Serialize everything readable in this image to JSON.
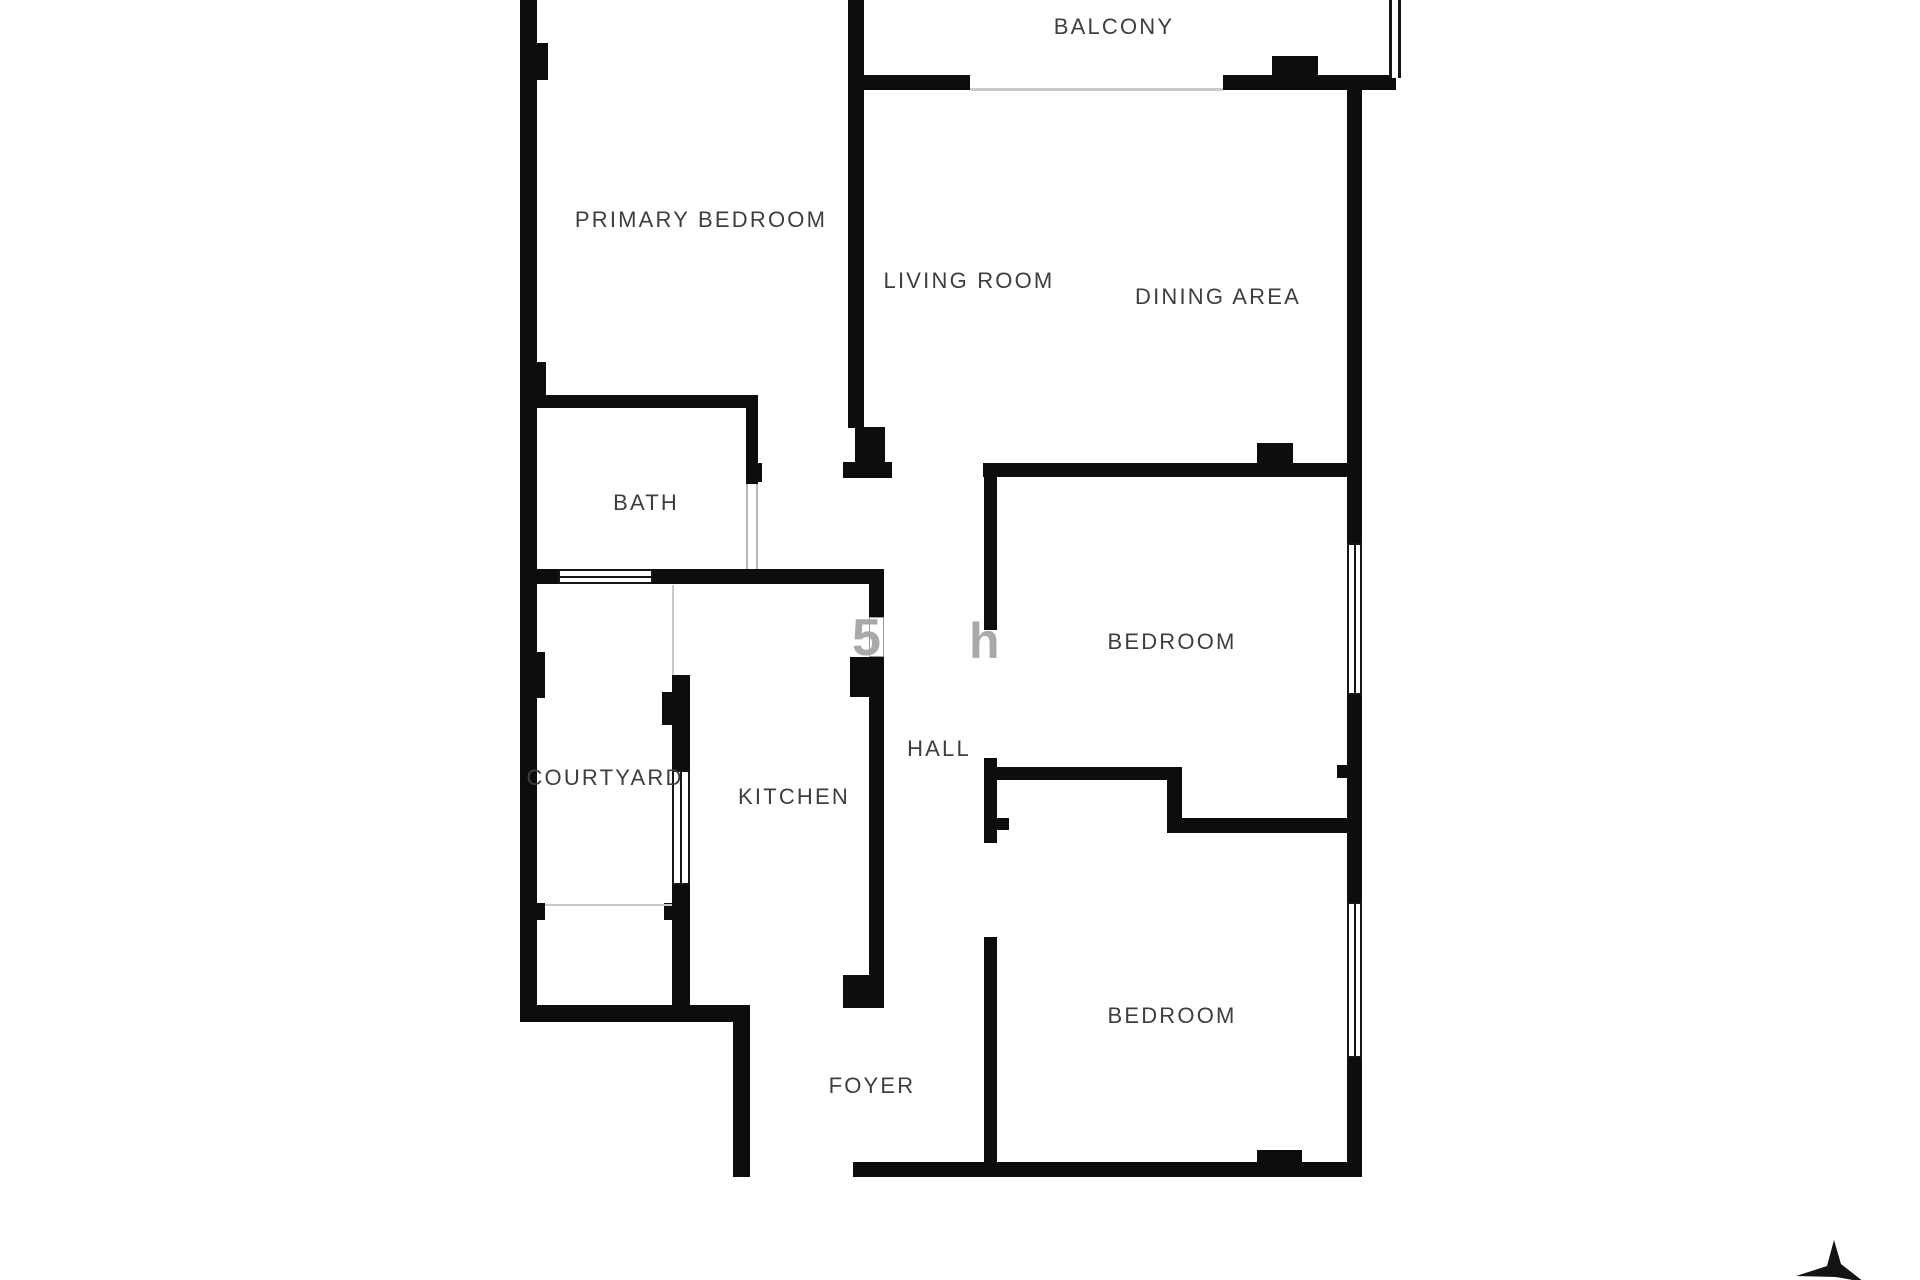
{
  "page": {
    "background": "#ffffff",
    "wall_color": "#0d0d0d",
    "label_color": "#3e3e3e",
    "watermark_color": "#a5a5a5",
    "title": "Apartment floor plan"
  },
  "rooms": [
    {
      "id": "balcony",
      "name": "BALCONY",
      "cx": 1114,
      "cy": 27
    },
    {
      "id": "primary-bedroom",
      "name": "PRIMARY BEDROOM",
      "cx": 701,
      "cy": 220
    },
    {
      "id": "living-room",
      "name": "LIVING ROOM",
      "cx": 969,
      "cy": 281
    },
    {
      "id": "dining-area",
      "name": "DINING AREA",
      "cx": 1218,
      "cy": 297
    },
    {
      "id": "bath",
      "name": "BATH",
      "cx": 646,
      "cy": 503
    },
    {
      "id": "bedroom-1",
      "name": "BEDROOM",
      "cx": 1172,
      "cy": 642
    },
    {
      "id": "courtyard",
      "name": "COURTYARD",
      "cx": 605,
      "cy": 778
    },
    {
      "id": "kitchen",
      "name": "KITCHEN",
      "cx": 794,
      "cy": 797
    },
    {
      "id": "hall",
      "name": "HALL",
      "cx": 939,
      "cy": 749
    },
    {
      "id": "bedroom-2",
      "name": "BEDROOM",
      "cx": 1172,
      "cy": 1016
    },
    {
      "id": "foyer",
      "name": "FOYER",
      "cx": 872,
      "cy": 1086
    }
  ],
  "watermark": {
    "fragments": [
      {
        "char": "5",
        "x": 852,
        "y": 612,
        "size": 52
      },
      {
        "char": "h",
        "x": 969,
        "y": 616,
        "size": 50
      }
    ]
  },
  "floorplan": {
    "walls": [
      [
        520,
        0,
        17,
        1022
      ],
      [
        537,
        43,
        11,
        37
      ],
      [
        537,
        362,
        9,
        38
      ],
      [
        520,
        395,
        238,
        13
      ],
      [
        746,
        408,
        12,
        76
      ],
      [
        754,
        463,
        8,
        19
      ],
      [
        848,
        0,
        16,
        428
      ],
      [
        855,
        427,
        30,
        36
      ],
      [
        843,
        462,
        49,
        16
      ],
      [
        848,
        75,
        122,
        15
      ],
      [
        1223,
        75,
        173,
        15
      ],
      [
        1272,
        56,
        46,
        19
      ],
      [
        1347,
        88,
        15,
        455
      ],
      [
        1347,
        695,
        15,
        207
      ],
      [
        1347,
        1058,
        15,
        119
      ],
      [
        983,
        463,
        379,
        14
      ],
      [
        1257,
        443,
        36,
        20
      ],
      [
        984,
        477,
        13,
        153
      ],
      [
        984,
        758,
        13,
        85
      ],
      [
        997,
        818,
        12,
        12
      ],
      [
        984,
        937,
        13,
        225
      ],
      [
        984,
        767,
        198,
        13
      ],
      [
        1167,
        780,
        15,
        53
      ],
      [
        1167,
        818,
        195,
        15
      ],
      [
        1337,
        765,
        10,
        13
      ],
      [
        520,
        569,
        38,
        15
      ],
      [
        653,
        569,
        231,
        15
      ],
      [
        869,
        584,
        15,
        33
      ],
      [
        850,
        657,
        34,
        40
      ],
      [
        869,
        697,
        15,
        278
      ],
      [
        843,
        975,
        41,
        33
      ],
      [
        672,
        675,
        18,
        95
      ],
      [
        662,
        692,
        10,
        33
      ],
      [
        672,
        885,
        18,
        137
      ],
      [
        664,
        903,
        8,
        17
      ],
      [
        520,
        1005,
        230,
        17
      ],
      [
        733,
        1020,
        17,
        157
      ],
      [
        537,
        652,
        8,
        46
      ],
      [
        537,
        903,
        8,
        17
      ],
      [
        853,
        1162,
        509,
        15
      ],
      [
        1257,
        1150,
        45,
        14
      ]
    ],
    "windows": [
      {
        "kind": "h",
        "x": 558,
        "y": 569,
        "w": 95,
        "h": 15
      },
      {
        "kind": "v",
        "x": 672,
        "y": 770,
        "w": 18,
        "h": 115
      },
      {
        "kind": "v",
        "x": 1347,
        "y": 543,
        "w": 15,
        "h": 152
      },
      {
        "kind": "v",
        "x": 1347,
        "y": 902,
        "w": 15,
        "h": 156
      },
      {
        "kind": "plain",
        "x": 869,
        "y": 617,
        "w": 15,
        "h": 40
      }
    ],
    "railing": {
      "x": 1389,
      "y": 0,
      "w": 12,
      "h": 78
    },
    "thin_lines": [
      [
        970,
        88,
        253,
        3
      ],
      [
        545,
        904,
        127,
        2
      ],
      [
        672,
        585,
        2,
        90
      ]
    ],
    "door_jambs": [
      [
        746,
        484,
        2,
        85
      ],
      [
        756,
        484,
        2,
        85
      ]
    ],
    "compass": {
      "x": 1790,
      "y": 1238,
      "w": 80,
      "h": 44,
      "points": "44,2 51,26 74,44 46,39 6,38 37,28"
    }
  }
}
